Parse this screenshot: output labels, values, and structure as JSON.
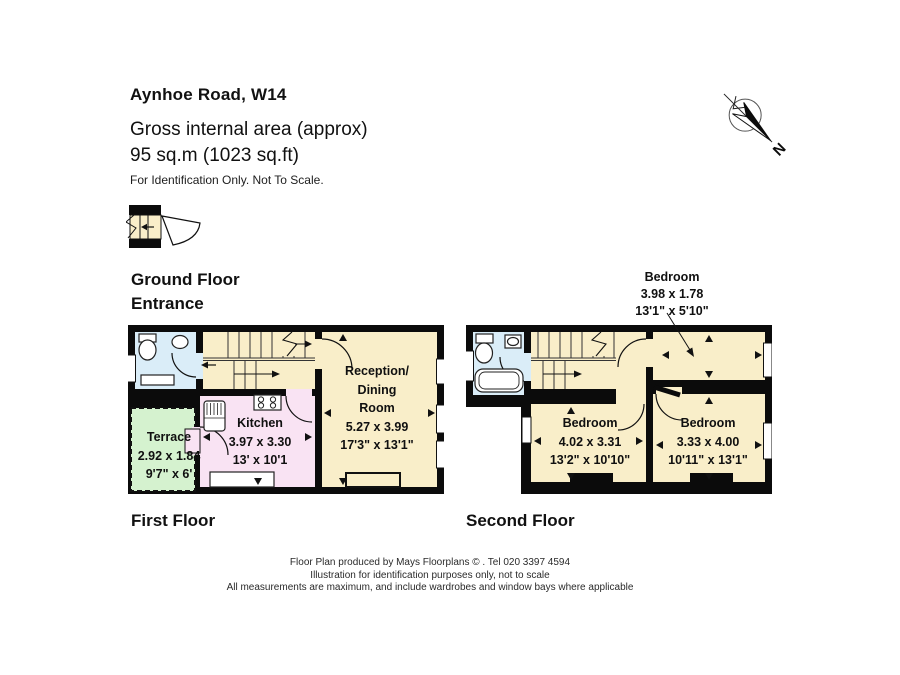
{
  "header": {
    "title": "Aynhoe Road, W14",
    "area_line1": "Gross internal area (approx)",
    "area_line2": "95 sq.m (1023 sq.ft)",
    "note": "For Identification Only. Not To Scale."
  },
  "compass": {
    "label": "N"
  },
  "floor_labels": {
    "ground_line1": "Ground Floor",
    "ground_line2": "Entrance",
    "first": "First Floor",
    "second": "Second Floor"
  },
  "rooms": {
    "reception": {
      "name1": "Reception/",
      "name2": "Dining",
      "name3": "Room",
      "metric": "5.27 x 3.99",
      "imperial": "17'3\" x 13'1\""
    },
    "kitchen": {
      "name": "Kitchen",
      "metric": "3.97 x 3.30",
      "imperial": "13' x 10'1"
    },
    "terrace": {
      "name": "Terrace",
      "metric": "2.92 x 1.84",
      "imperial": "9'7\" x 6'"
    },
    "bedroom_rear": {
      "name": "Bedroom",
      "metric": "4.02 x 3.31",
      "imperial": "13'2\" x 10'10\""
    },
    "bedroom_front": {
      "name": "Bedroom",
      "metric": "3.33 x 4.00",
      "imperial": "10'11\" x 13'1\""
    },
    "bedroom_small": {
      "name": "Bedroom",
      "metric": "3.98 x 1.78",
      "imperial": "13'1\" x 5'10\""
    }
  },
  "footer": {
    "line1": "Floor Plan produced by Mays Floorplans © . Tel 020 3397 4594",
    "line2": "Illustration for identification purposes only, not to scale",
    "line3": "All measurements are maximum, and include wardrobes and window bays where applicable"
  },
  "colors": {
    "wall": "#0b0b0b",
    "room_cream": "#f9eec9",
    "room_pink": "#f9e3f3",
    "room_green": "#d5f2cf",
    "room_blue": "#daedf8"
  }
}
